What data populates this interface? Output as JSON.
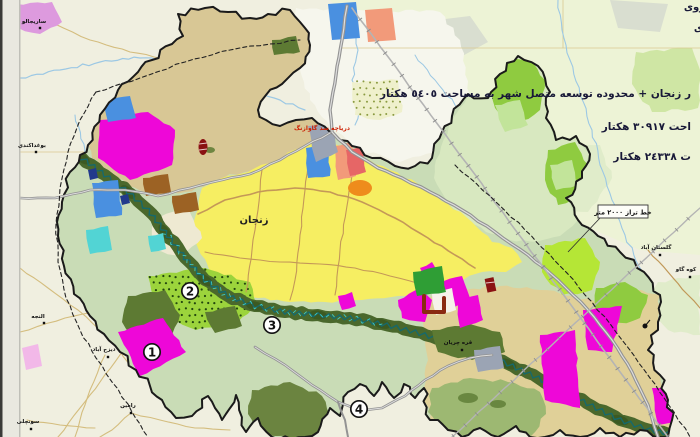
{
  "map": {
    "city_label": "زنجان",
    "lake_label": "دریاچه سد گاوازنگ",
    "contour_label": "خط تراز ٢٠٠٠ متر",
    "legend_lines": [
      "ر زنجان + محدوده توسعه متصل شهر به مساحت ٥٤٠٥ هکتار",
      "احت ٣٠٩١٧ هکتار",
      "ت ٢٤٣٣٨ هکتار"
    ],
    "edge_fragments": [
      "روی",
      "ی"
    ],
    "area_numbers": [
      "1",
      "2",
      "3",
      "4"
    ],
    "villages": [
      {
        "name": "ساریجالو",
        "x": 40,
        "y": 28,
        "tx": 34,
        "ty": 23
      },
      {
        "name": "بوغداکندی",
        "x": 36,
        "y": 152,
        "tx": 32,
        "ty": 147
      },
      {
        "name": "النجه",
        "x": 44,
        "y": 323,
        "tx": 38,
        "ty": 318
      },
      {
        "name": "دیزج آباد",
        "x": 108,
        "y": 357,
        "tx": 104,
        "ty": 351
      },
      {
        "name": "رامین",
        "x": 131,
        "y": 413,
        "tx": 128,
        "ty": 407
      },
      {
        "name": "سونچلی",
        "x": 31,
        "y": 429,
        "tx": 28,
        "ty": 423
      },
      {
        "name": "گلستان آباد",
        "x": 660,
        "y": 255,
        "tx": 656,
        "ty": 249
      },
      {
        "name": "کوه گاو",
        "x": 690,
        "y": 277,
        "tx": 686,
        "ty": 271
      },
      {
        "name": "قره چریان",
        "x": 462,
        "y": 350,
        "tx": 458,
        "ty": 344
      }
    ]
  },
  "colors": {
    "outsideBg": "#f0efe0",
    "pageStrip": "#e9e8e0",
    "pageEdge": "#3a3a38",
    "stripLine": "#bfbfb8",
    "topWash": "#edf3d6",
    "bayWhite": "#f6f6ed",
    "grayBlob": "#d9ded0",
    "lightGreenBlob": "#cfe6a4",
    "paleGreenBlob": "#e0ecca",
    "regionBase": "#c9dcb6",
    "neLobe": "#d8e8c0",
    "neLight": "#c2e49a",
    "tanZone": "#d8c795",
    "seTan": "#e0d098",
    "cityYellow": "#f6ee62",
    "cream": "#eee9d2",
    "dottedGreen": "#9cd43c",
    "dotColor": "#23470f",
    "bayDotFill": "#eff0cc",
    "bayDot": "#8a9a40",
    "oliveYellow": "#c8c22a",
    "brightGreen": "#8fcb40",
    "chartreuse": "#b5e636",
    "olive": "#5d7a33",
    "lobeOlive": "#6b8440",
    "lobeSage": "#9db872",
    "corridor": "#4a682c",
    "corridorDark": "#324f1c",
    "riverTeal": "#17696a",
    "riverCyan": "#3fc8c4",
    "navyBit": "#223a8c",
    "magenta": "#ee07d8",
    "violetOutside": "#dd9ade",
    "palePink": "#f2b8e8",
    "blue": "#4a90e0",
    "cyan": "#52d4d4",
    "salmon": "#f29a7a",
    "redPink": "#e66666",
    "orange": "#ee8c1c",
    "brown": "#9c6224",
    "darkGreenRect": "#2f9e35",
    "grayPatch": "#9ba4b4",
    "redMarker": "#8a1212",
    "roadGray": "#939393",
    "roadCore": "#dedede",
    "railGray": "#b4b4b4",
    "tickGray": "#8a8a8a",
    "roadTan": "#c49858",
    "roadKhaki": "#d4bd7e",
    "brownRoad": "#c09858",
    "stream": "#9cc8e4",
    "grid": "#d9c98f",
    "boundary": "#1a1a1a",
    "dash": "#222222",
    "white": "#f6f2ea"
  }
}
